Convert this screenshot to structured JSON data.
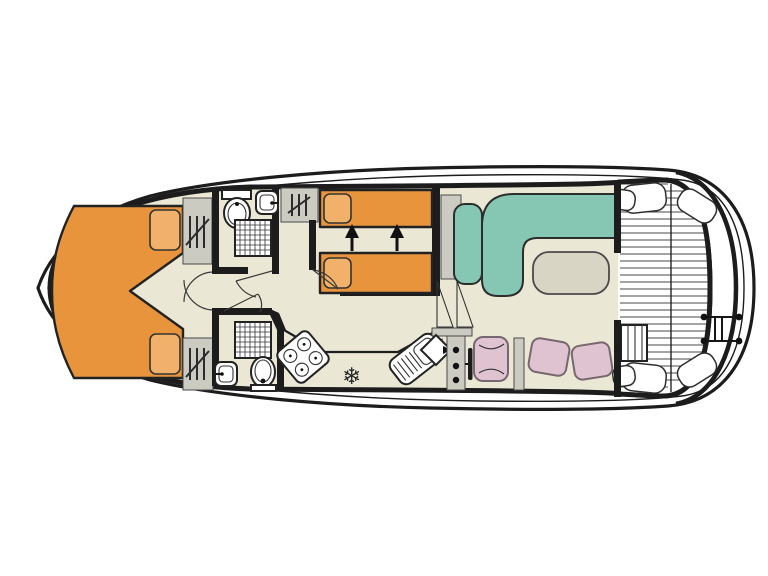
{
  "colors": {
    "background": "#ffffff",
    "wall_line": "#1c1c1c",
    "floor": "#eae7d5",
    "deck": "#ffffff",
    "slat_line": "#4a4a4a",
    "bed": "#e8943c",
    "pillow": "#f2b16b",
    "sofa": "#85c7b2",
    "seat_pink": "#dfc3d0",
    "table": "#d8d5c5",
    "cabinet_gray": "#cbcbc2",
    "fixture_white": "#ffffff"
  },
  "symbols": {
    "fridge_snowflake": "❄"
  },
  "features": [
    "bow-double-berth",
    "wardrobes",
    "forward-bathroom",
    "aft-bathroom",
    "twin-berth-cabin",
    "slide-together-beds",
    "galley",
    "helm-station",
    "l-shaped-saloon-sofa",
    "saloon-table",
    "aft-deck",
    "stern-ladder"
  ]
}
